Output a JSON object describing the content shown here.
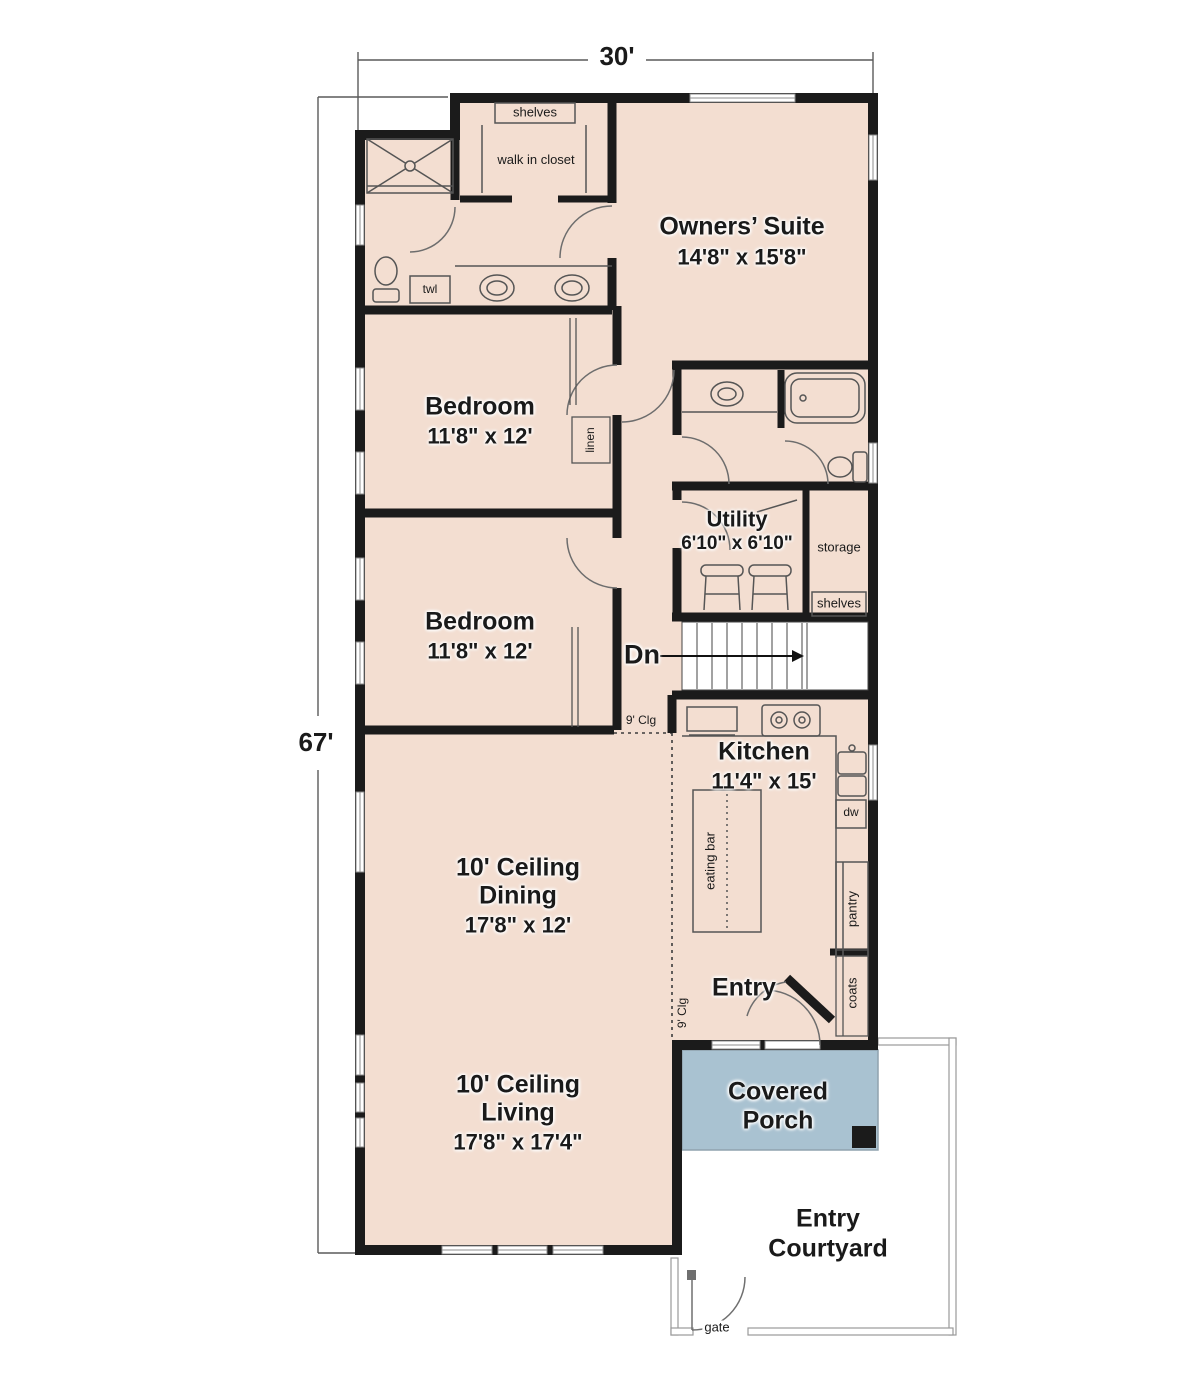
{
  "dimensions": {
    "width_label": "30'",
    "height_label": "67'"
  },
  "rooms": {
    "owners_suite": {
      "name": "Owners’ Suite",
      "size": "14'8\" x 15'8\""
    },
    "bedroom_upper": {
      "name": "Bedroom",
      "size": "11'8\" x 12'"
    },
    "bedroom_lower": {
      "name": "Bedroom",
      "size": "11'8\" x 12'"
    },
    "utility": {
      "name": "Utility",
      "size": "6'10\" x 6'10\""
    },
    "kitchen": {
      "name": "Kitchen",
      "size": "11'4\" x 15'"
    },
    "dining": {
      "ceiling": "10' Ceiling",
      "name": "Dining",
      "size": "17'8\" x 12'"
    },
    "living": {
      "ceiling": "10' Ceiling",
      "name": "Living",
      "size": "17'8\" x 17'4\""
    },
    "entry": {
      "name": "Entry"
    },
    "covered_porch": {
      "line1": "Covered",
      "line2": "Porch"
    },
    "entry_courtyard": {
      "line1": "Entry",
      "line2": "Courtyard"
    }
  },
  "annotations": {
    "closet_shelves": "shelves",
    "walk_in_closet": "walk in closet",
    "towel": "twl",
    "linen": "linen",
    "storage": "storage",
    "utility_shelves": "shelves",
    "stairs_down": "Dn",
    "ceiling_kitchen": "9' Clg",
    "ceiling_entry": "9' Clg",
    "eating_bar": "eating bar",
    "dishwasher": "dw",
    "pantry": "pantry",
    "coats": "coats",
    "gate": "gate"
  },
  "colors": {
    "floor": "#f3ded1",
    "wall": "#1b1b1b",
    "porch": "#a9c2d1",
    "line": "#6f6f6f"
  }
}
